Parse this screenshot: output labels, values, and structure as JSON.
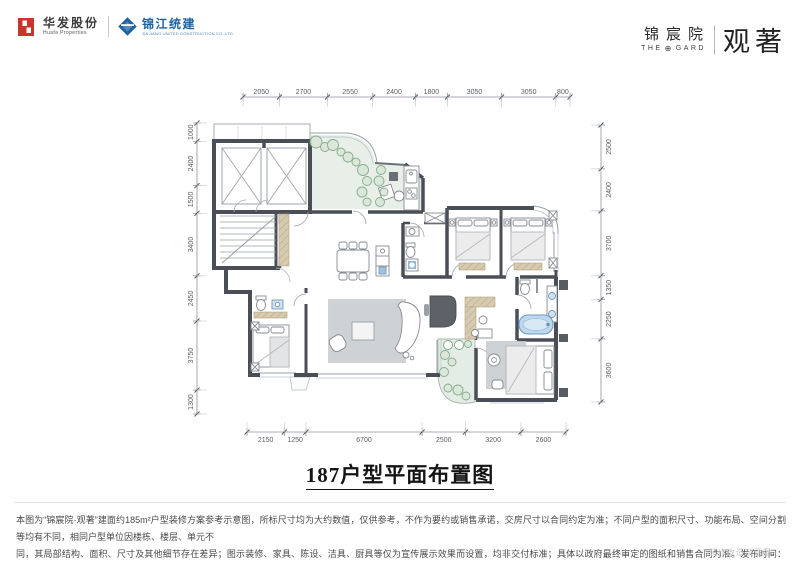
{
  "header": {
    "huafa": {
      "name": "华发股份",
      "sub": "Huafa Properties"
    },
    "jinjiang": {
      "name": "锦江统建",
      "sub": "JINJIANG UNITED CONSTRUCTION CO.,LTD"
    },
    "project": {
      "name": "锦宸院",
      "sub_left": "THE",
      "sub_right": "GARD",
      "emblem": "⊕",
      "brand": "观著"
    }
  },
  "plan": {
    "title": "187户型平面布置图",
    "dimensions": {
      "top": [
        2050,
        2700,
        2550,
        2400,
        1800,
        3050,
        3050,
        800
      ],
      "bottom": [
        2150,
        1250,
        6700,
        2500,
        3200,
        2600
      ],
      "left": [
        1000,
        2400,
        1500,
        3400,
        2450,
        3750,
        1300
      ],
      "right": [
        2500,
        2400,
        3700,
        1350,
        2250,
        3600
      ]
    }
  },
  "footer": {
    "disclaimer_line1": "本图为“锦宸院·观著”建面约185m²户型装修方案参考示意图，所标尺寸均为大约数值，仅供参考，不作为要约或销售承诺，交房尺寸以合同约定为准；不同户型的面积尺寸、功能布局、空间分割等均有不同，相同户型单位因楼栋、楼层、单元不",
    "disclaimer_line2": "同，其局部结构、面积、尺寸及其他细节存在差异；图示装修、家具、陈设、洁具、厨具等仅为宣传展示效果而设置，均非交付标准；具体以政府最终审定的图纸和销售合同为准。发布时间：2025年12月。",
    "watermark": "装修改造示意图"
  },
  "colors": {
    "wall": "#4a4f57",
    "huafa_red": "#c8352b",
    "jinjiang_blue": "#1e63a4",
    "garden_green": "#e7efe8",
    "plant_green": "#7fa588",
    "tub_blue": "#bcd8ee",
    "rug_gray": "#c8cacc",
    "dim_text": "#5a5f66"
  }
}
